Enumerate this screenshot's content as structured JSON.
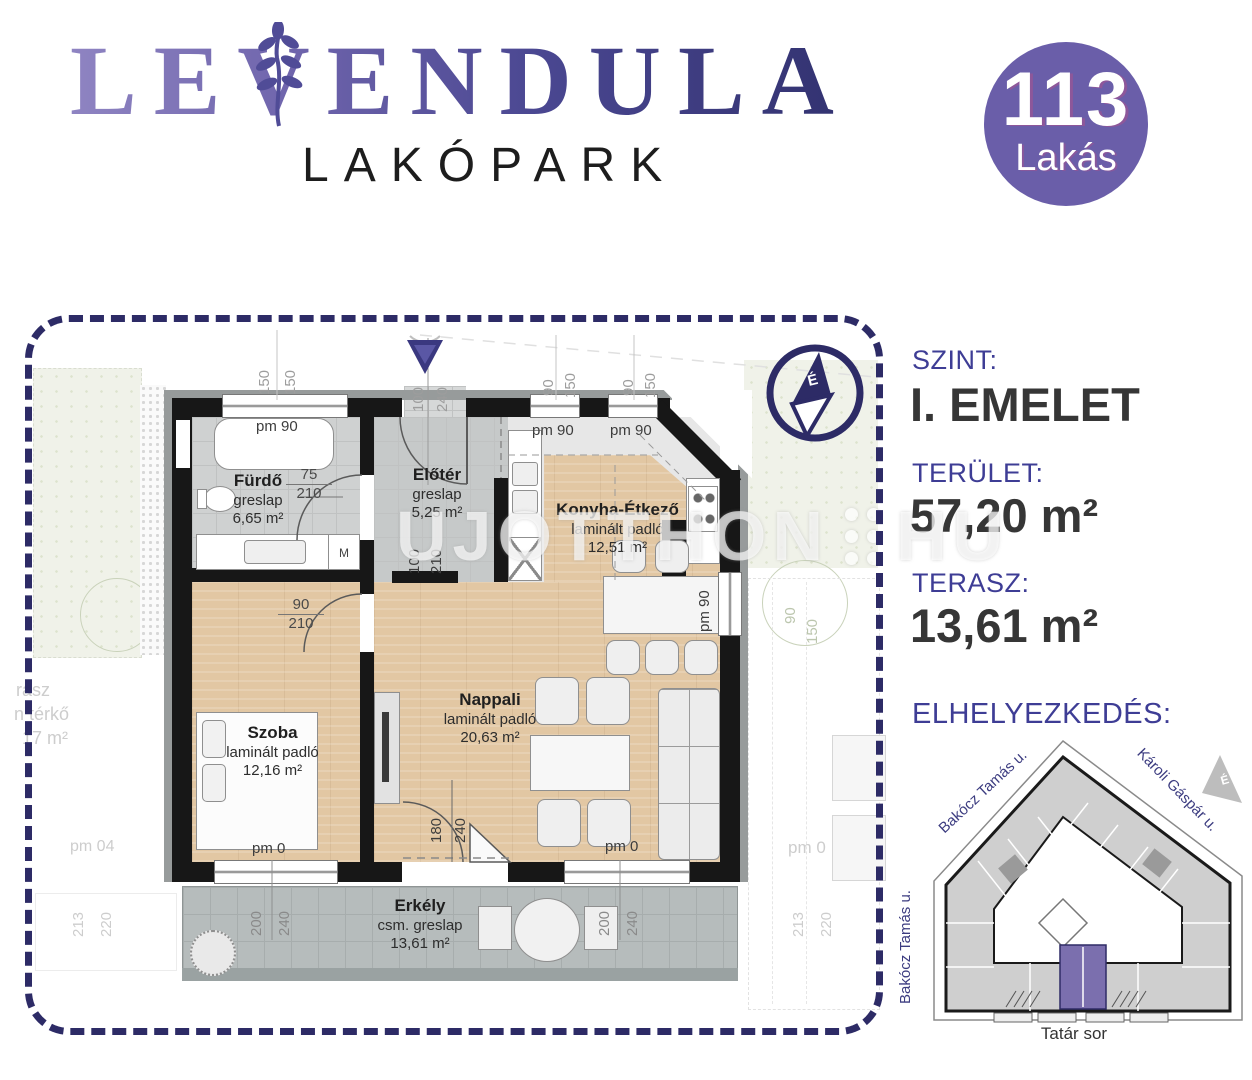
{
  "header": {
    "brand": "LEVENDULA",
    "brand_sub": "LAKÓPARK"
  },
  "badge": {
    "number": "113",
    "label": "Lakás"
  },
  "watermark": {
    "left": "UJOTTHON",
    "right": "HU"
  },
  "panel": {
    "szint_label": "SZINT:",
    "szint_value": "I. EMELET",
    "terulet_label": "TERÜLET:",
    "terulet_value": "57,20 m²",
    "terasz_label": "TERASZ:",
    "terasz_value": "13,61 m²",
    "elhelyezkedes_label": "ELHELYEZKEDÉS:"
  },
  "site_plan": {
    "street_top_left": "Bakócz Tamás u.",
    "street_top_right": "Károli Gáspár u.",
    "street_left": "Bakócz Tamás u.",
    "street_bottom": "Tatár sor",
    "compass": "É",
    "highlight_color": "#7b6fae"
  },
  "floorplan": {
    "compass": "É",
    "rooms": [
      {
        "name": "Fürdő",
        "floor": "greslap",
        "area": "6,65 m²"
      },
      {
        "name": "Előtér",
        "floor": "greslap",
        "area": "5,25 m²"
      },
      {
        "name": "Konyha-Étkező",
        "floor": "laminált padló",
        "area": "12,51 m²"
      },
      {
        "name": "Szoba",
        "floor": "laminált padló",
        "area": "12,16 m²"
      },
      {
        "name": "Nappali",
        "floor": "laminált padló",
        "area": "20,63 m²"
      },
      {
        "name": "Erkély",
        "floor": "csm. greslap",
        "area": "13,61 m²"
      }
    ],
    "labels": {
      "tub": "pm 90",
      "kwin_a": "pm 90",
      "kwin_b": "pm 90",
      "kwin_r": "pm 90",
      "sill": "pm 0",
      "washer": "M",
      "bath_w": "75",
      "bath_h": "210",
      "szoba_w": "90",
      "szoba_h": "210",
      "entry_w": "100",
      "entry_h": "210",
      "bdoor_w": "180",
      "bdoor_h": "240"
    },
    "dims": {
      "a1": "150",
      "a2": "150",
      "b1": "100",
      "b2": "240",
      "c1": "90",
      "c2": "150",
      "d1": "90",
      "d2": "150",
      "bal_l1": "200",
      "bal_l2": "240",
      "bal_r1": "200",
      "bal_r2": "240",
      "out_l1": "213",
      "out_l2": "220",
      "out_r1": "213",
      "out_r2": "220",
      "garden_a": "90",
      "garden_b": "150"
    },
    "neighbor": {
      "t1": "rasz",
      "t2": "n térkő",
      "t3": "17 m²",
      "pm04": "pm 04",
      "pm0": "pm 0"
    }
  }
}
